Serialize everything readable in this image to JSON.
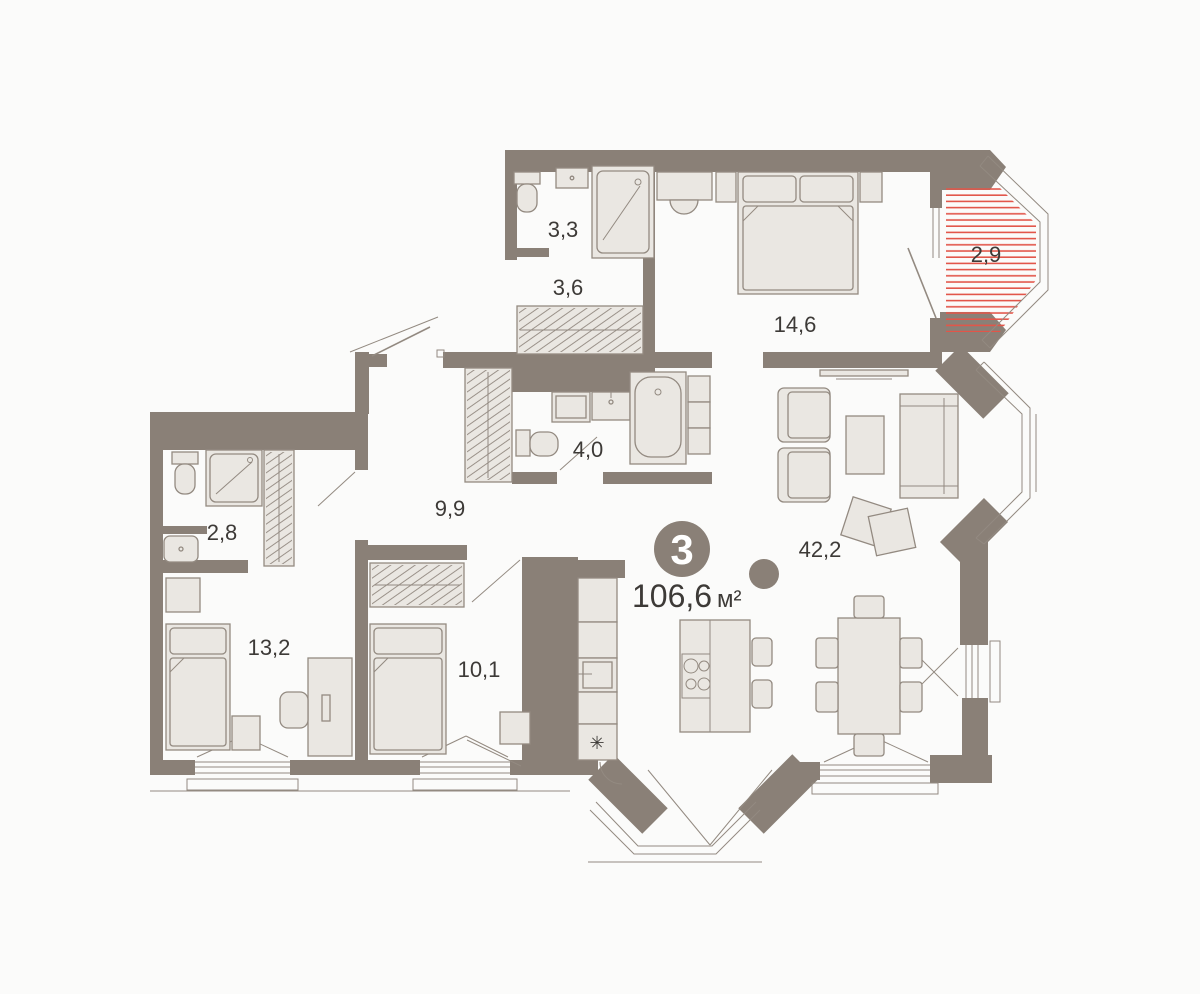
{
  "plan": {
    "title": "apartment-floor-plan",
    "badge": {
      "rooms_count": "3",
      "area": "106,6",
      "unit": "м²"
    },
    "rooms": [
      {
        "id": "bathroom-top",
        "area": "3,3"
      },
      {
        "id": "closet",
        "area": "3,6"
      },
      {
        "id": "bedroom-main",
        "area": "14,6"
      },
      {
        "id": "balcony",
        "area": "2,9"
      },
      {
        "id": "bathroom-main",
        "area": "4,0"
      },
      {
        "id": "hallway",
        "area": "9,9"
      },
      {
        "id": "bathroom-left",
        "area": "2,8"
      },
      {
        "id": "bedroom-left",
        "area": "13,2"
      },
      {
        "id": "bedroom-small",
        "area": "10,1"
      },
      {
        "id": "living-kitchen",
        "area": "42,2"
      }
    ],
    "icons": {
      "kitchen_appliance": "✳"
    },
    "colors": {
      "wall": "#8a8077",
      "furniture_fill": "#eae7e2",
      "furniture_stroke": "#938a81",
      "balcony_hatch": "#e25549",
      "text": "#3d3a37",
      "badge_fill": "#8a8077",
      "badge_text": "#ffffff",
      "background": "#fbfbfa"
    }
  }
}
